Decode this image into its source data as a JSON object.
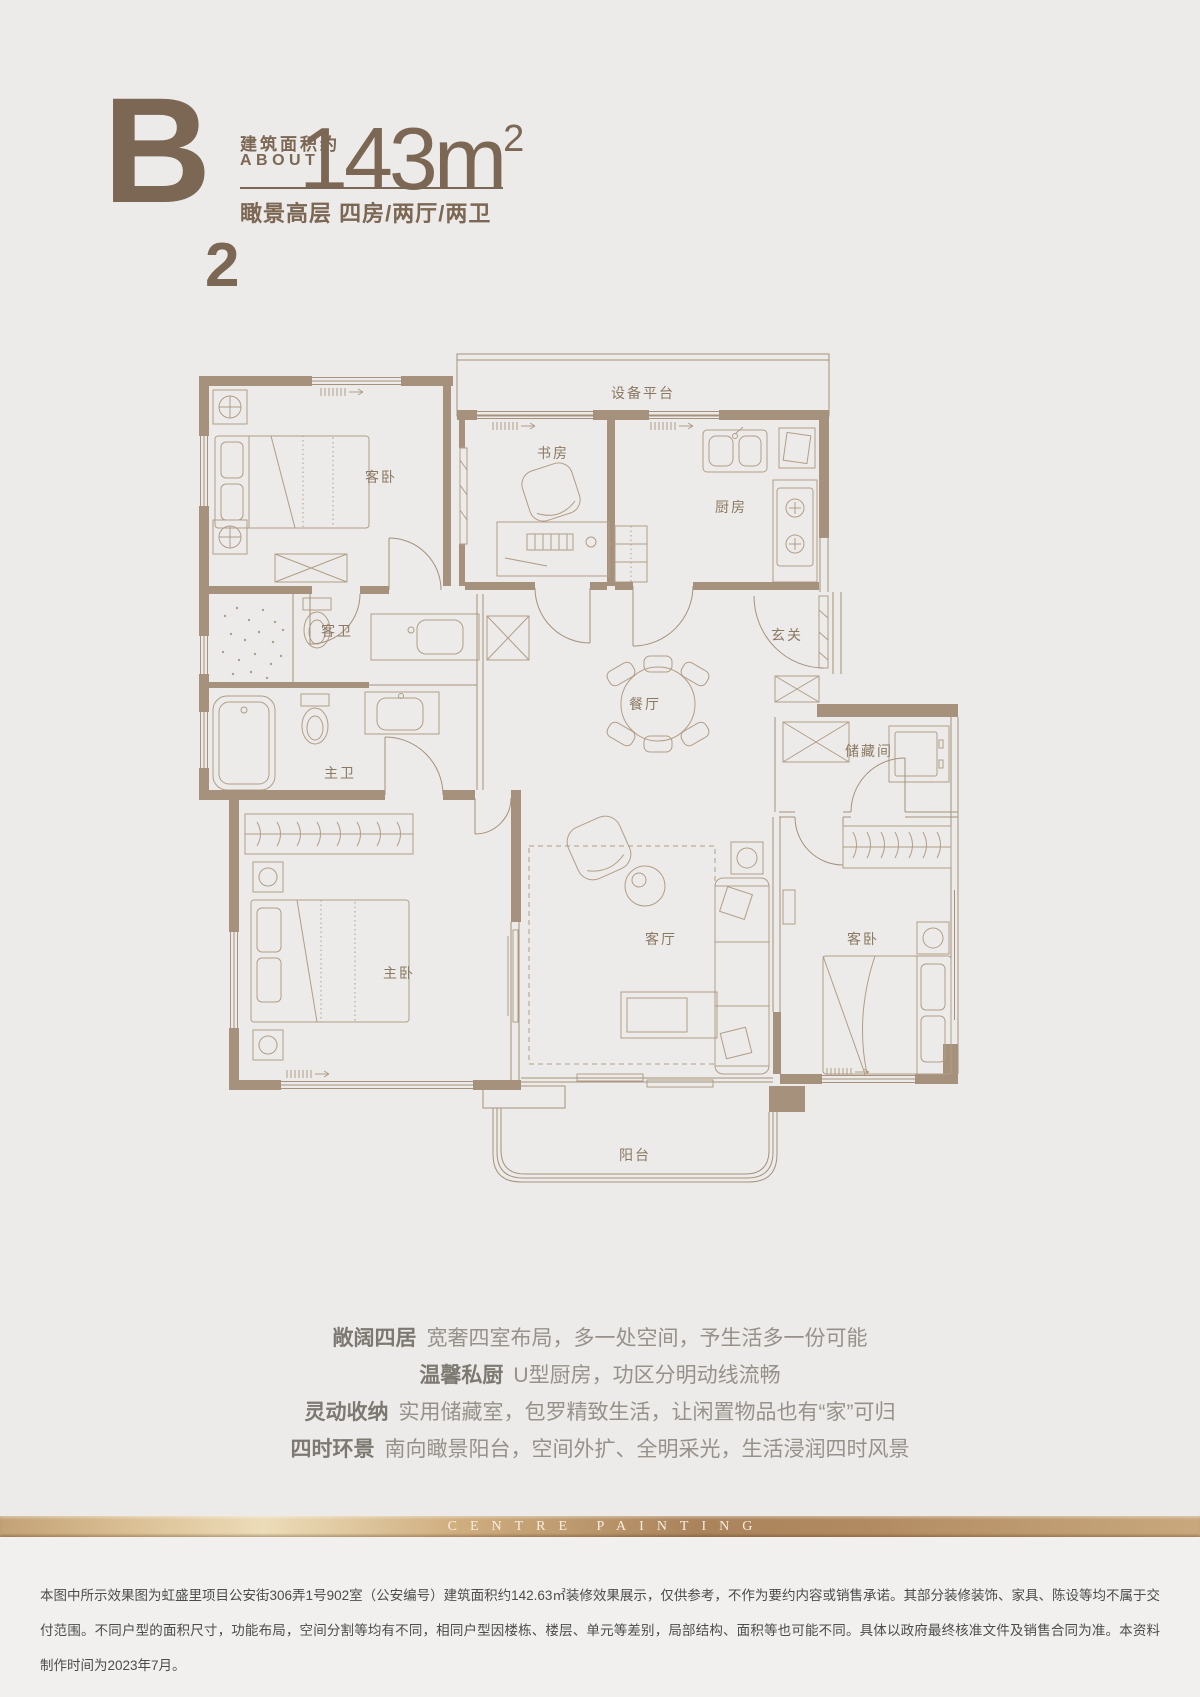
{
  "header": {
    "type_letter": "B",
    "type_sub": "2",
    "area_label_cn": "建筑面积约",
    "area_label_en": "ABOUT",
    "area_number": "143m",
    "area_sup": "2",
    "subtitle": "瞰景高层 四房/两厅/两卫"
  },
  "floorplan": {
    "rooms": [
      {
        "id": "equipment-platform",
        "label": "设备平台"
      },
      {
        "id": "bedroom-top-left",
        "label": "客卧"
      },
      {
        "id": "study",
        "label": "书房"
      },
      {
        "id": "kitchen",
        "label": "厨房"
      },
      {
        "id": "foyer",
        "label": "玄关"
      },
      {
        "id": "guest-bath",
        "label": "客卫"
      },
      {
        "id": "dining",
        "label": "餐厅"
      },
      {
        "id": "master-bath",
        "label": "主卫"
      },
      {
        "id": "storage",
        "label": "储藏间"
      },
      {
        "id": "master-bedroom",
        "label": "主卧"
      },
      {
        "id": "living",
        "label": "客厅"
      },
      {
        "id": "bedroom-right",
        "label": "客卧"
      },
      {
        "id": "balcony",
        "label": "阳台"
      }
    ]
  },
  "features": [
    {
      "title": "敞阔四居",
      "desc": "宽奢四室布局，多一处空间，予生活多一份可能"
    },
    {
      "title": "温馨私厨",
      "desc": "U型厨房，功区分明动线流畅"
    },
    {
      "title": "灵动收纳",
      "desc": "实用储藏室，包罗精致生活，让闲置物品也有“家”可归"
    },
    {
      "title": "四时环景",
      "desc": "南向瞰景阳台，空间外扩、全明采光，生活浸润四时风景"
    }
  ],
  "brand": {
    "text": "CENTRE PAINTING"
  },
  "disclaimer": {
    "text": "本图中所示效果图为虹盛里项目公安街306弄1号902室（公安编号）建筑面积约142.63㎡装修效果展示，仅供参考，不作为要约内容或销售承诺。其部分装修装饰、家具、陈设等均不属于交付范围。不同户型的面积尺寸，功能布局，空间分割等均有不同，相同户型因楼栋、楼层、单元等差别，局部结构、面积等也可能不同。具体以政府最终核准文件及销售合同为准。本资料制作时间为2023年7月。"
  },
  "colors": {
    "brand_brown": "#7b6753",
    "wall": "#a6917c",
    "furniture_line": "#b29d87",
    "gold": "#c9a87e",
    "page_bg": "#ecebe9"
  }
}
